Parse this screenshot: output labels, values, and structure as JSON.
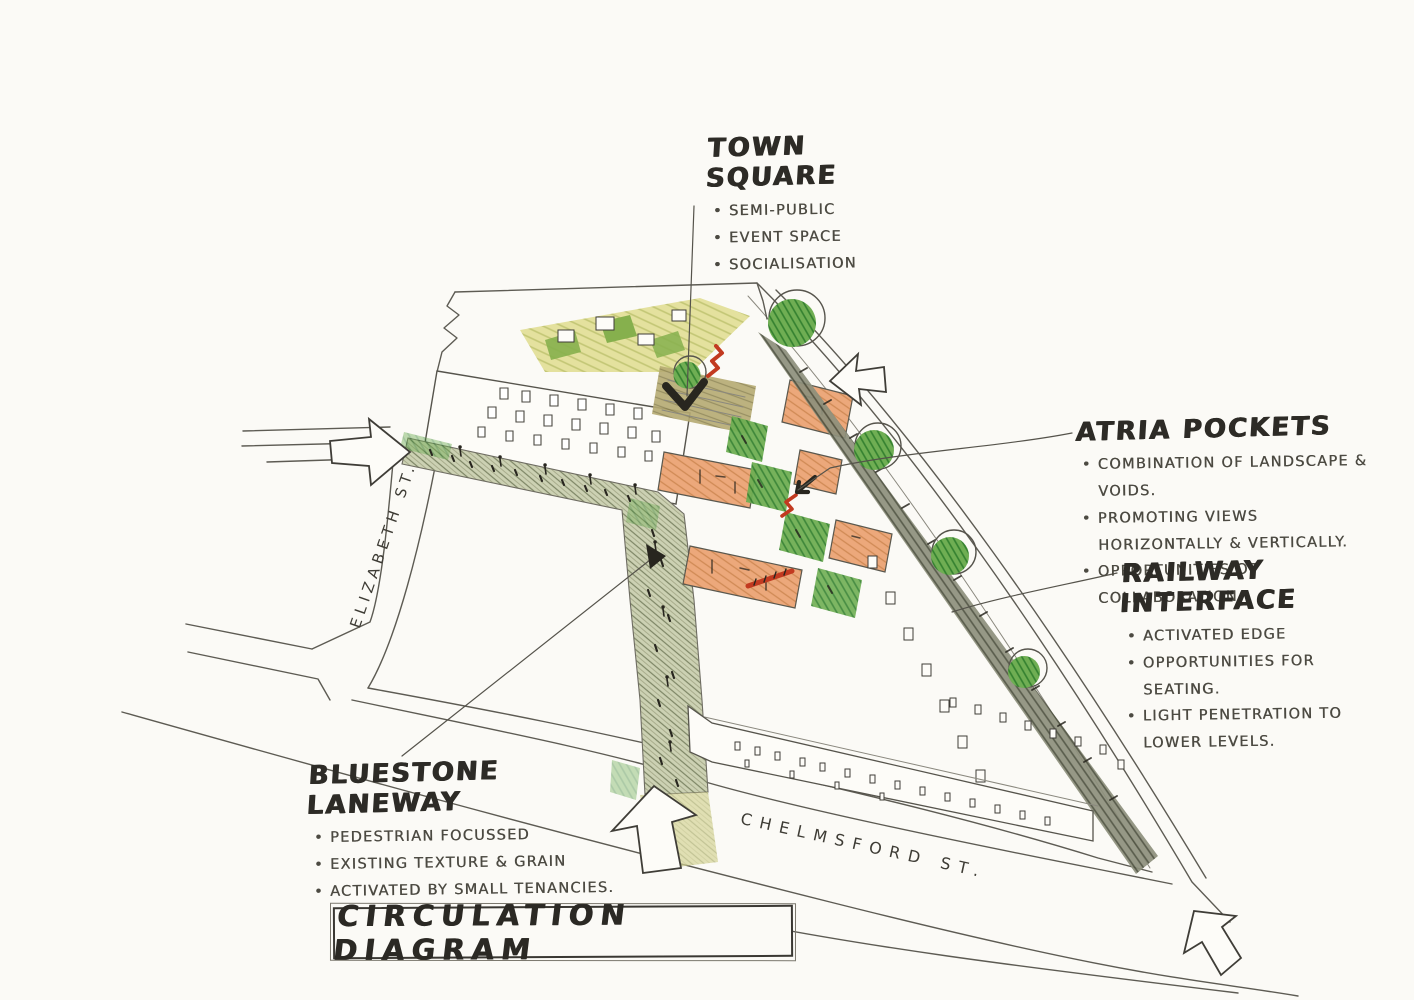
{
  "title_block": {
    "label": "CIRCULATION DIAGRAM"
  },
  "annotations": {
    "town_square": {
      "heading": "TOWN SQUARE",
      "bullets": [
        "SEMI-PUBLIC",
        "EVENT SPACE",
        "SOCIALISATION"
      ]
    },
    "atria_pockets": {
      "heading": "ATRIA POCKETS",
      "bullets": [
        "COMBINATION OF LANDSCAPE & VOIDS.",
        "PROMOTING VIEWS HORIZONTALLY & VERTICALLY.",
        "OPPORTUNITIES OF COLLABORATION."
      ]
    },
    "railway_interface": {
      "heading": "RAILWAY INTERFACE",
      "bullets": [
        "ACTIVATED EDGE",
        "OPPORTUNITIES FOR SEATING.",
        "LIGHT PENETRATION TO LOWER LEVELS."
      ]
    },
    "bluestone_laneway": {
      "heading": "BLUESTONE LANEWAY",
      "bullets": [
        "PEDESTRIAN FOCUSSED",
        "EXISTING TEXTURE & GRAIN",
        "ACTIVATED BY SMALL TENANCIES."
      ]
    }
  },
  "streets": {
    "left": "ELIZABETH ST.",
    "bottom": "CHELMSFORD ST."
  },
  "colors": {
    "paper": "#fbfaf6",
    "pencil": "#5d5b53",
    "ink": "#28261f",
    "note": "#4c4a42",
    "red": "#c23a20",
    "orange": "#eca87b",
    "orange-hatch": "#d08a55",
    "lane": "#ccd1b3",
    "lane-hatch": "#7d8565",
    "lane-yellow": "#ded76e",
    "rail": "#8d907c",
    "rail-hatch": "#4a4d3c",
    "tree": "#6fae53",
    "tree-dark": "#33802f",
    "roof-yellow": "#e0dd8f",
    "roof-green": "#86b04d",
    "square-tan": "#b5aa72",
    "square-hatch": "#8d8452"
  }
}
